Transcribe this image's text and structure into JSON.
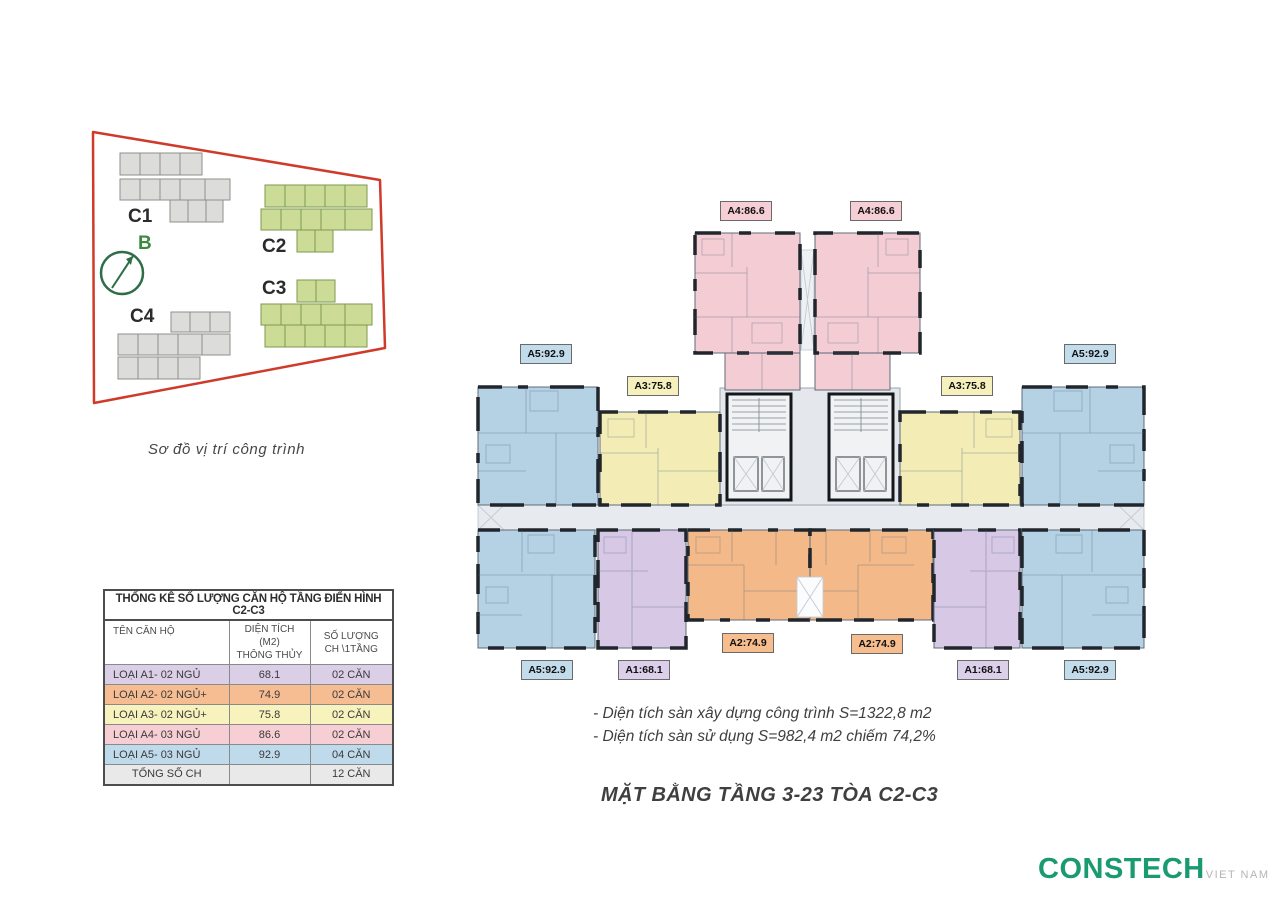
{
  "site_plan": {
    "caption": "Sơ đồ vị trí công trình",
    "north_label": "B",
    "building_labels": {
      "c1": "C1",
      "c2": "C2",
      "c3": "C3",
      "c4": "C4"
    }
  },
  "stats_table": {
    "title": "THỐNG KÊ SỐ LƯỢNG CĂN HỘ TẦNG ĐIỂN HÌNH C2-C3",
    "col1": "TÊN CĂN HỘ",
    "col2_line1": "DIỆN TÍCH (M2)",
    "col2_line2": "THÔNG THỦY",
    "col3_line1": "SỐ LƯỢNG",
    "col3_line2": "CH \\1TẦNG",
    "rows": [
      {
        "name": "LOẠI A1- 02 NGỦ",
        "area": "68.1",
        "qty": "02 CĂN"
      },
      {
        "name": "LOẠI A2- 02 NGỦ+",
        "area": "74.9",
        "qty": "02 CĂN"
      },
      {
        "name": "LOẠI A3- 02 NGỦ+",
        "area": "75.8",
        "qty": "02 CĂN"
      },
      {
        "name": "LOẠI A4- 03 NGỦ",
        "area": "86.6",
        "qty": "02 CĂN"
      },
      {
        "name": "LOẠI A5- 03 NGỦ",
        "area": "92.9",
        "qty": "04 CĂN"
      }
    ],
    "total_label": "TỔNG SỐ CH",
    "total_qty": "12 CĂN"
  },
  "floor_plan": {
    "unit_labels": {
      "a4_left": "A4:86.6",
      "a4_right": "A4:86.6",
      "a5_top_left": "A5:92.9",
      "a5_top_right": "A5:92.9",
      "a3_left": "A3:75.8",
      "a3_right": "A3:75.8",
      "a2_left": "A2:74.9",
      "a2_right": "A2:74.9",
      "a1_left": "A1:68.1",
      "a1_right": "A1:68.1",
      "a5_bottom_left": "A5:92.9",
      "a5_bottom_right": "A5:92.9"
    }
  },
  "notes": {
    "line1": "- Diện tích sàn xây dựng công trình S=1322,8 m2",
    "line2": "- Diện tích sàn sử dụng S=982,4 m2 chiếm 74,2%"
  },
  "main_title": "MẶT BẰNG TẦNG 3-23 TÒA C2-C3",
  "logo": {
    "brand": "CONSTECH",
    "suffix": "VIET NAM"
  },
  "colors": {
    "unit_a1": "#d7c9e6",
    "unit_a2": "#f4b989",
    "unit_a3": "#f3edb5",
    "unit_a4": "#f4ccd3",
    "unit_a5": "#b5d2e4",
    "boundary_red": "#cf3a2a",
    "site_green": "#ccdb96",
    "site_gray": "#dcdcda",
    "logo_green": "#1a9a71"
  }
}
